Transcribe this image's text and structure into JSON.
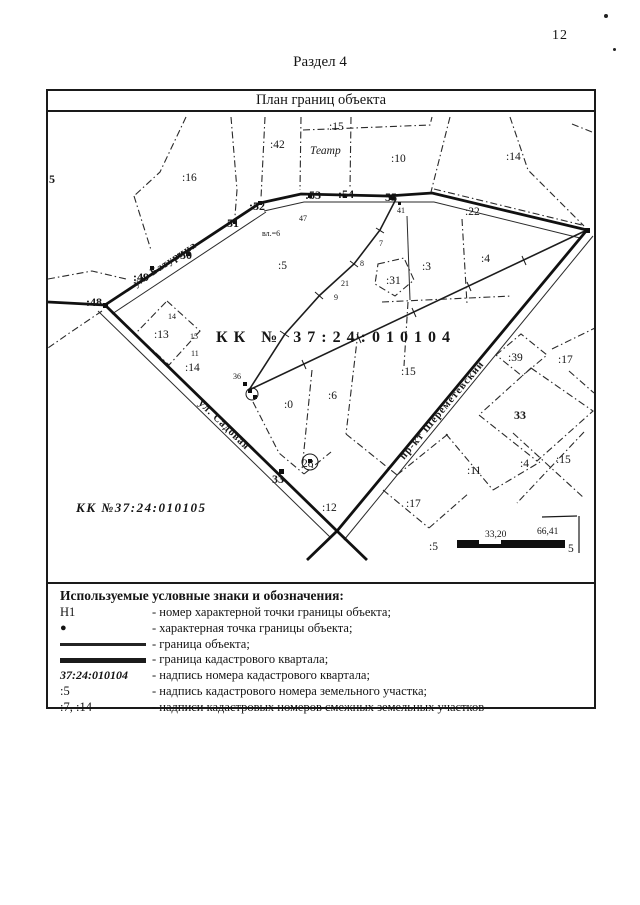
{
  "page": {
    "number": "12"
  },
  "document": {
    "section_title": "Раздел 4",
    "plan_title": "План границ объекта"
  },
  "map": {
    "quarter_main": "КК № 37:24:010104",
    "quarter_secondary": "КК №37:24:010105",
    "streets": {
      "top": "ул. Батурина",
      "bottom": "ул. Садовая",
      "right": "пр-кт Шереметевский"
    },
    "building": "Театр",
    "scale": {
      "d1": "33,20",
      "d2": "66,41",
      "left": ":5",
      "right": "5"
    },
    "labels": [
      ":42",
      ":15",
      ":10",
      ":14",
      ":16",
      "5",
      ":48",
      ":49",
      ":50",
      "51",
      ":52",
      ":53",
      ":54",
      "55",
      "41",
      "47",
      "вл.=6",
      ":5",
      ":22",
      ":3",
      ":31",
      ":4",
      ":13",
      ":14",
      "14",
      "15",
      "11",
      "36",
      "7",
      "8",
      "21",
      "9",
      ":15",
      ":6",
      ":0",
      "33",
      "28",
      ":12",
      ":17",
      ":39",
      ":17",
      "33",
      ":11",
      ":4",
      ":15"
    ]
  },
  "legend": {
    "title": "Используемые условные знаки и обозначения:",
    "rows": [
      {
        "symbol": "Н1",
        "text": "- номер характерной точки границы объекта;"
      },
      {
        "symbol": "●",
        "text": "- характерная точка границы объекта;"
      },
      {
        "symbol": "",
        "text": "- граница объекта;"
      },
      {
        "symbol": "",
        "text": "- граница кадастрового квартала;"
      },
      {
        "symbol": "37:24:010104",
        "text": "- надпись номера кадастрового квартала;"
      },
      {
        "symbol": ":5",
        "text": "- надпись кадастрового номера земельного участка;"
      },
      {
        "symbol": ":7, :14",
        "text": "- надписи кадастровых номеров смежных земельных участков"
      }
    ]
  }
}
